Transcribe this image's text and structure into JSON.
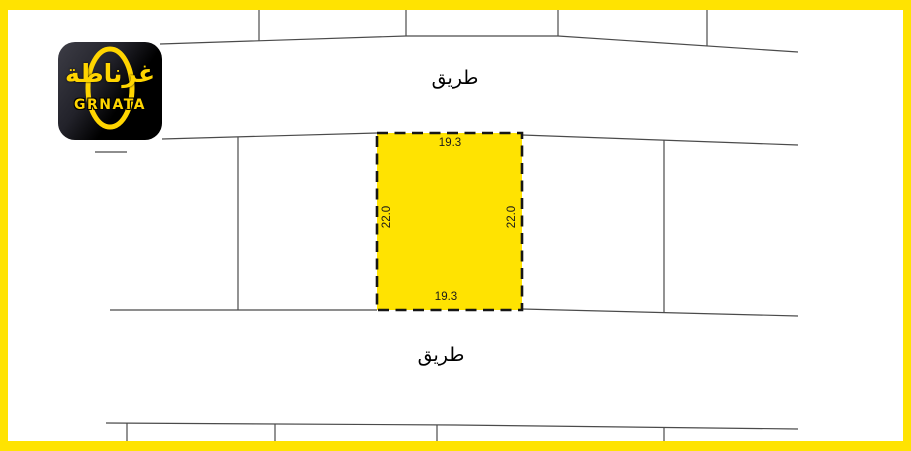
{
  "colors": {
    "frame_yellow": "#FFE301",
    "plot_yellow": "#FFE301",
    "line_gray": "#4b4b4b",
    "dash_black": "#161616",
    "label_black": "#1a1a1a",
    "logo_yellow": "#FFD500",
    "logo_background": "#000000"
  },
  "logo": {
    "arabic": "غرناطة",
    "latin": "GRNATA"
  },
  "map": {
    "road_label_top": "طريق",
    "road_label_bottom": "طريق",
    "highlighted_plot": {
      "dim_top": "19.3",
      "dim_bottom": "19.3",
      "dim_left": "22.0",
      "dim_right": "22.0"
    }
  }
}
